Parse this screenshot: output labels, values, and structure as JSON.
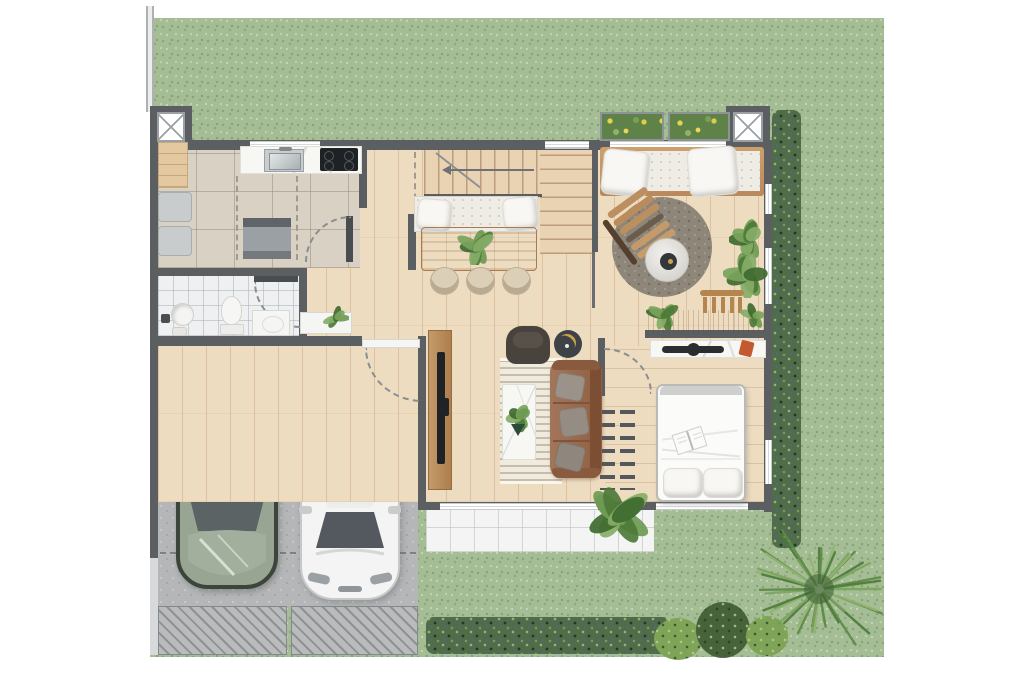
{
  "scene": {
    "kind": "Top-down 2D rendered floor plan of a house with garden, garage, two cars and full furnishing",
    "visible_text": "none",
    "canvas": {
      "width": 1024,
      "height": 683
    },
    "background": "#ffffff"
  },
  "palette": {
    "lawn": "#a4bd94",
    "hedge": "#506c4a",
    "wall": "#5c5f62",
    "wood_floor": "#eedcc1",
    "kitchen_tile": "#d9d2c4",
    "bathroom_tile": "#eef0f1",
    "patio_tile": "#f3f4f3",
    "concrete": "#b4b6b7",
    "furniture_wood": "#c3935f",
    "leather_sofa": "#96684a",
    "bed_linen": "#fafaf8",
    "car_green": "#99a593",
    "car_white": "#f3f4f3",
    "flower_yellow": "#e6d44e",
    "accent_orange": "#c4582f"
  },
  "exterior": {
    "lawn": "speckled grass surround",
    "left_fence": "double-line fence at top-left boundary",
    "right_hedge": "dense hedge along right facade",
    "bottom_hedge": "hedge row along south garden edge",
    "planter_boxes": 2,
    "round_bushes": 3,
    "large_tree": 1,
    "driveway_hatch_panels": 2
  },
  "garage": {
    "cars": [
      {
        "name": "suv",
        "color": "green"
      },
      {
        "name": "hatchback",
        "color": "white"
      }
    ],
    "parking_dash_lines": 2,
    "entry_step": 1,
    "door_swing": "into garage"
  },
  "structure": {
    "x_columns": 2,
    "windows_top": 3,
    "windows_right": 3,
    "windows_bottom": 2,
    "door_swings": 4
  },
  "rooms": {
    "kitchen": {
      "objects": [
        "counter with sink",
        "cooktop with 4 burners",
        "tall cabinet",
        "washer",
        "dryer",
        "island",
        "dashed overhead-cabinet outlines"
      ]
    },
    "bathroom": {
      "objects": [
        "toilet",
        "round basin",
        "stool",
        "vanity",
        "door swing"
      ]
    },
    "hallway": {
      "objects": [
        "entry console",
        "potted plant",
        "partition wall"
      ]
    },
    "staircase": {
      "flights": 2,
      "objects": [
        "direction arrow",
        "bench with 2 pillows"
      ]
    },
    "dining": {
      "objects": [
        "wood table",
        "centerpiece plant",
        "3 chairs"
      ]
    },
    "lounge": {
      "objects": [
        "daybed with 2 pillows",
        "round rug",
        "slatted armchair",
        "round pouf table",
        "2 potted plants"
      ]
    },
    "living": {
      "objects": [
        "leather sofa with 3 cushions",
        "dark armchair",
        "round side table",
        "patterned rug",
        "marble coffee table with plant",
        "tv sideboard",
        "tv"
      ]
    },
    "study": {
      "objects": [
        "desk",
        "slatted chair",
        "2 plants"
      ]
    },
    "bedroom": {
      "objects": [
        "double bed",
        "open book",
        "2 pillows",
        "ladder clothes rack",
        "marble console",
        "soundbar",
        "orange book",
        "door swing"
      ]
    },
    "patio": {
      "objects": [
        "tiled terrace",
        "large potted plant"
      ]
    }
  }
}
